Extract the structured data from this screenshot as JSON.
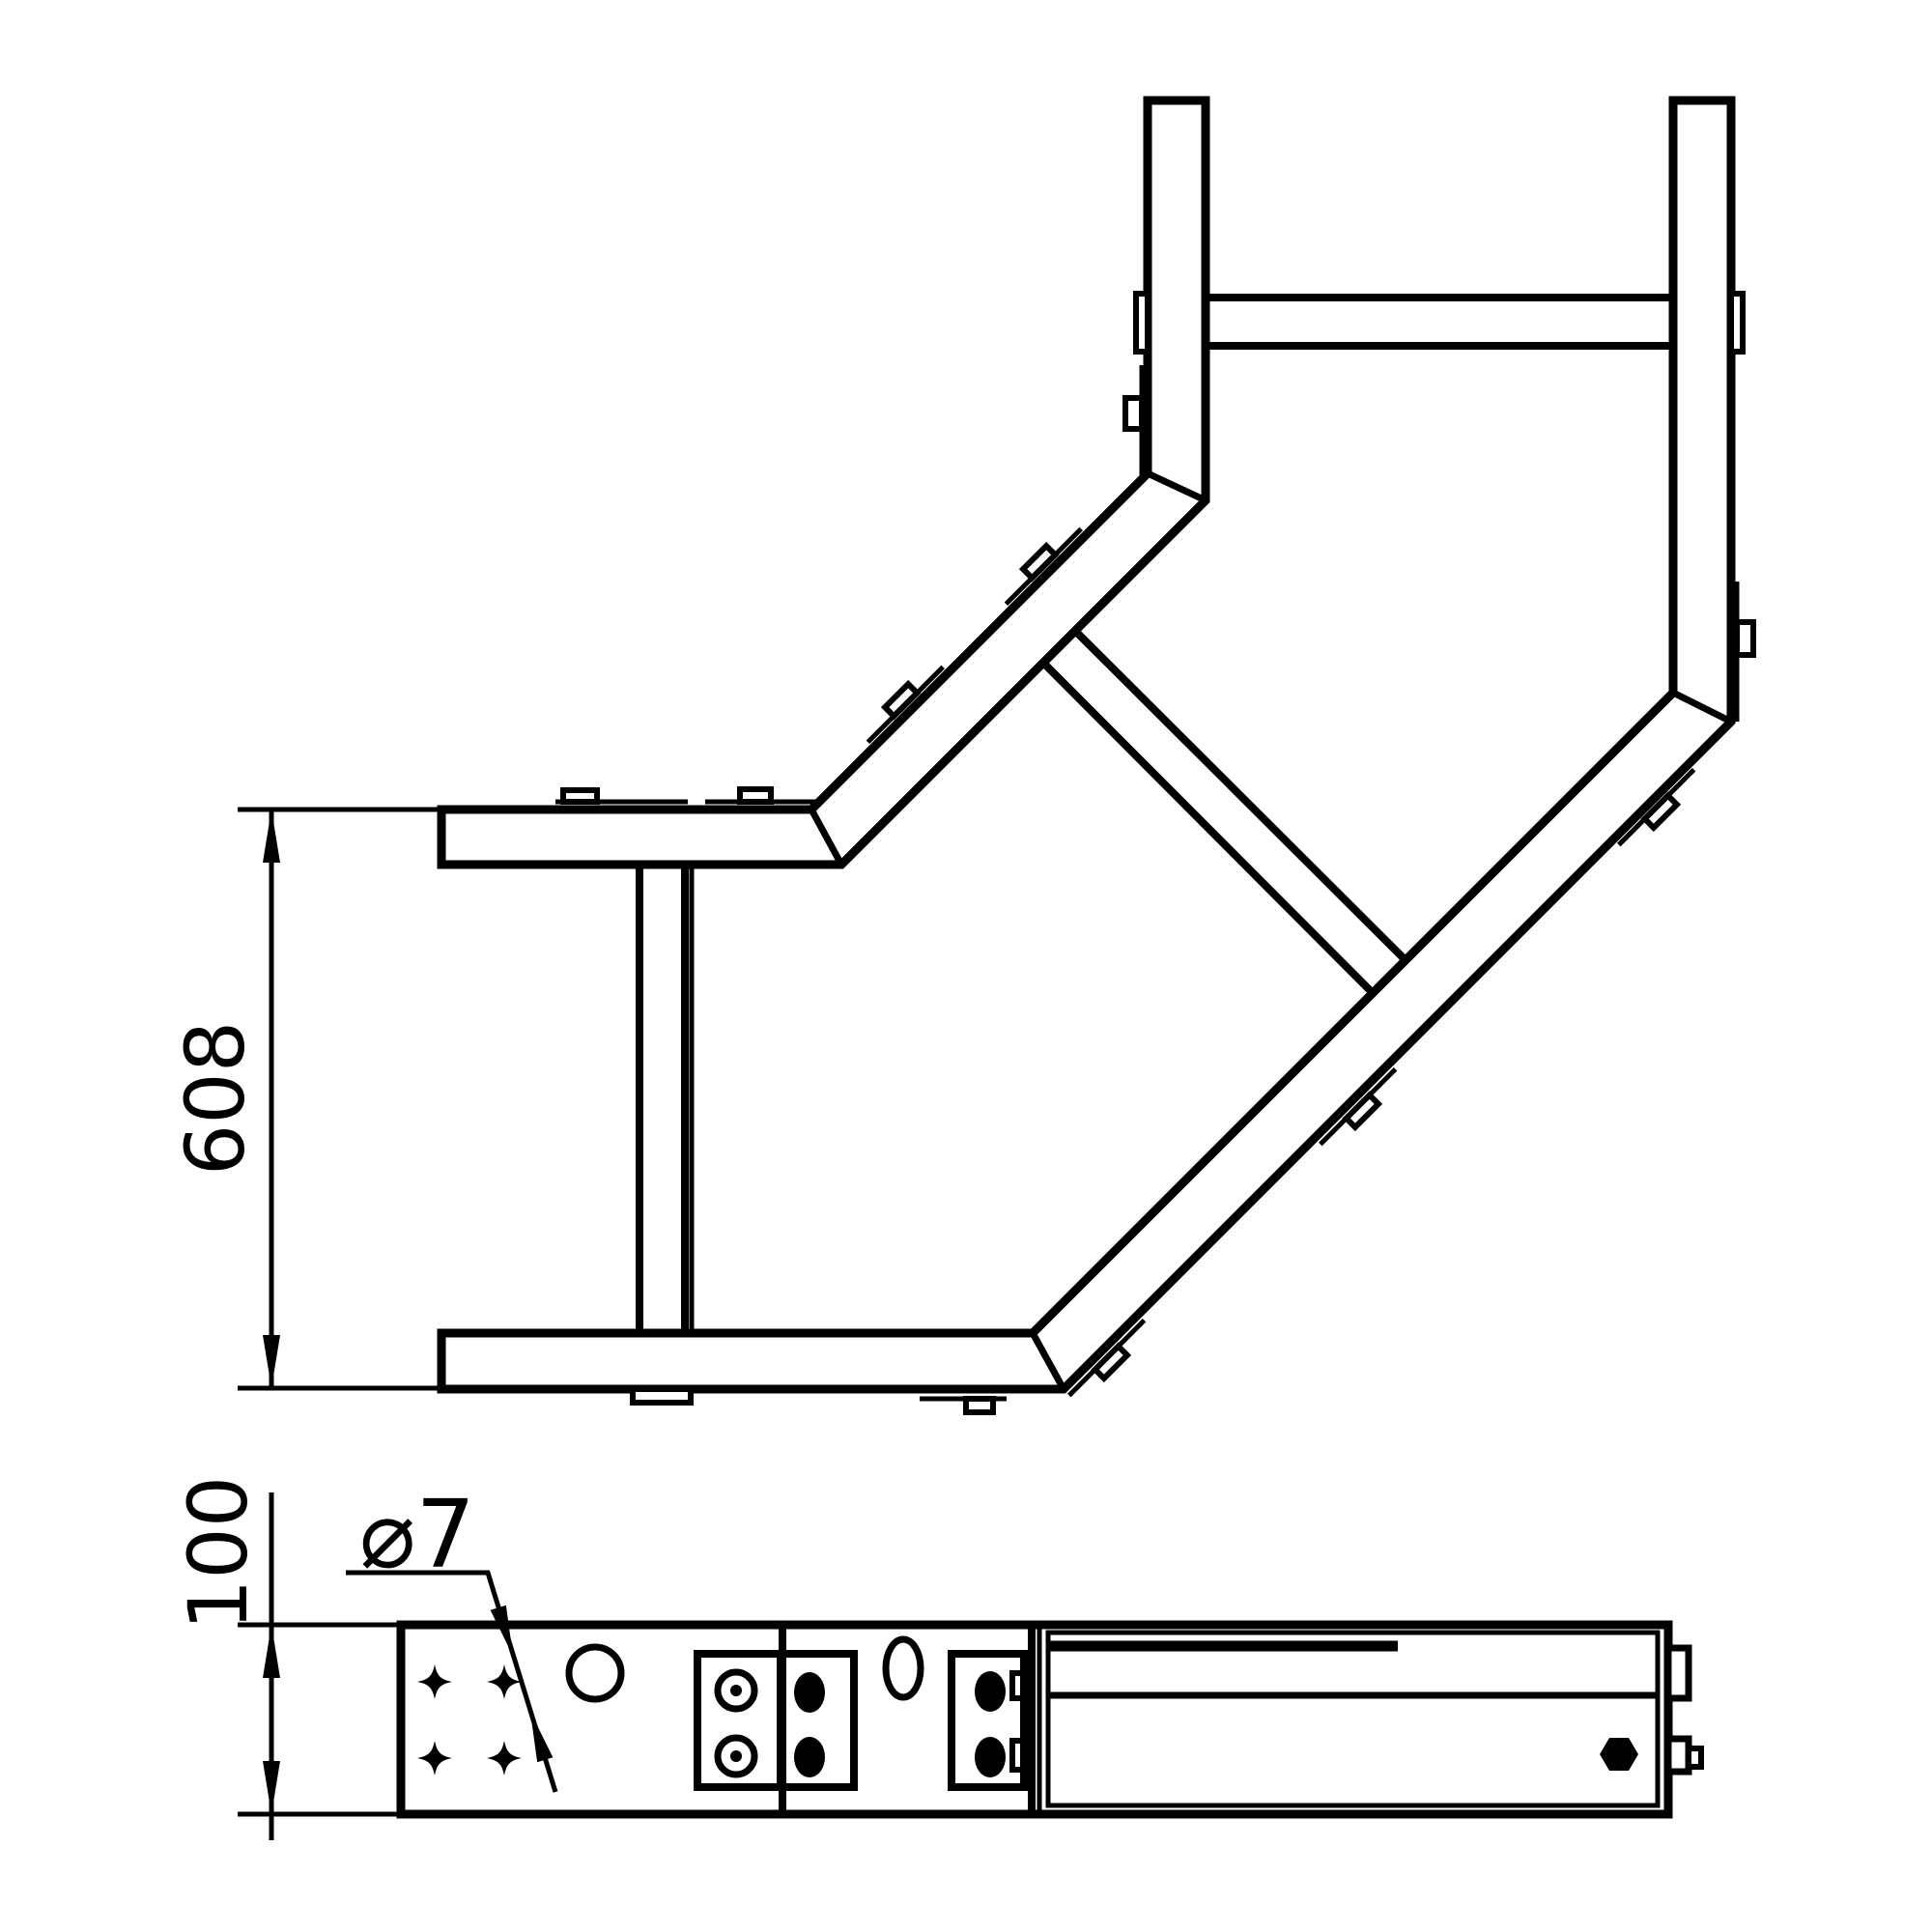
{
  "drawing": {
    "type": "technical-drawing",
    "subject": "cable-ladder-90-degree-bend",
    "views": {
      "top_view": "plan view of ladder bend with rungs and connector tabs",
      "side_view": "side elevation with splice plates, bolts and holes"
    },
    "labels": {
      "height_dim": "608",
      "profile_height_dim": "100",
      "hole_diameter": "⌀7"
    },
    "colors": {
      "ink": "#000000",
      "paper": "#ffffff"
    }
  }
}
